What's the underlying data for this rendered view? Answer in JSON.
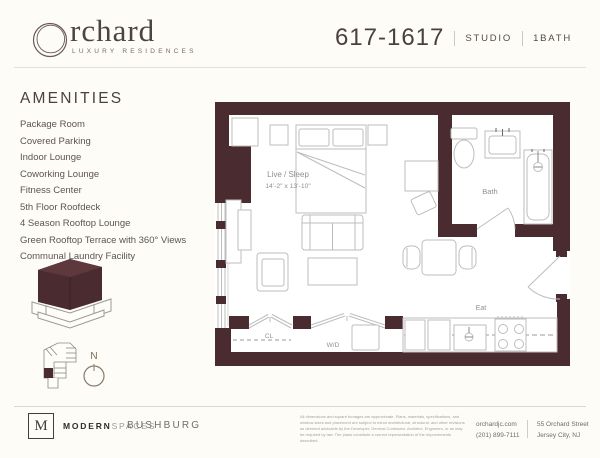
{
  "brand": {
    "logo_text": "rchard",
    "logo_tagline": "LUXURY RESIDENCES"
  },
  "header": {
    "unit_number": "617-1617",
    "unit_type": "STUDIO",
    "unit_bath": "1BATH"
  },
  "amenities": {
    "title": "AMENITIES",
    "items": [
      "Package Room",
      "Covered Parking",
      "Indoor Lounge",
      "Coworking Lounge",
      "Fitness Center",
      "5th Floor Roofdeck",
      "4 Season Rooftop Lounge",
      "Green Rooftop Terrace with 360° Views",
      "Communal Laundry Facility"
    ]
  },
  "floorplan": {
    "labels": {
      "live_sleep": "Live / Sleep",
      "live_sleep_dims": "14'-2\" x 13'-10\"",
      "bath": "Bath",
      "closet": "CL",
      "washer_dryer": "W/D",
      "eat": "Eat"
    },
    "compass": "N",
    "wall_color": "#4a2b2f",
    "line_color": "#bdbdbd"
  },
  "footer": {
    "broker_logo_letter": "M",
    "broker_name_bold": "MODERN",
    "broker_name_light": "SPACES",
    "developer_name": "BUSHBURG",
    "disclaimer": "All dimensions and square footages are approximate. Plans, materials, specifications, and window sizes and placement are subject to minor architectural, structural, and other revisions as deemed advisable by the Developer, General Contractor, Architect, Engineers, or as may be required by law. The plans constitute a correct representation of the improvements described.",
    "website": "orchardjc.com",
    "phone": "(201) 899-7111",
    "address_line1": "55 Orchard Street",
    "address_line2": "Jersey City, NJ"
  }
}
